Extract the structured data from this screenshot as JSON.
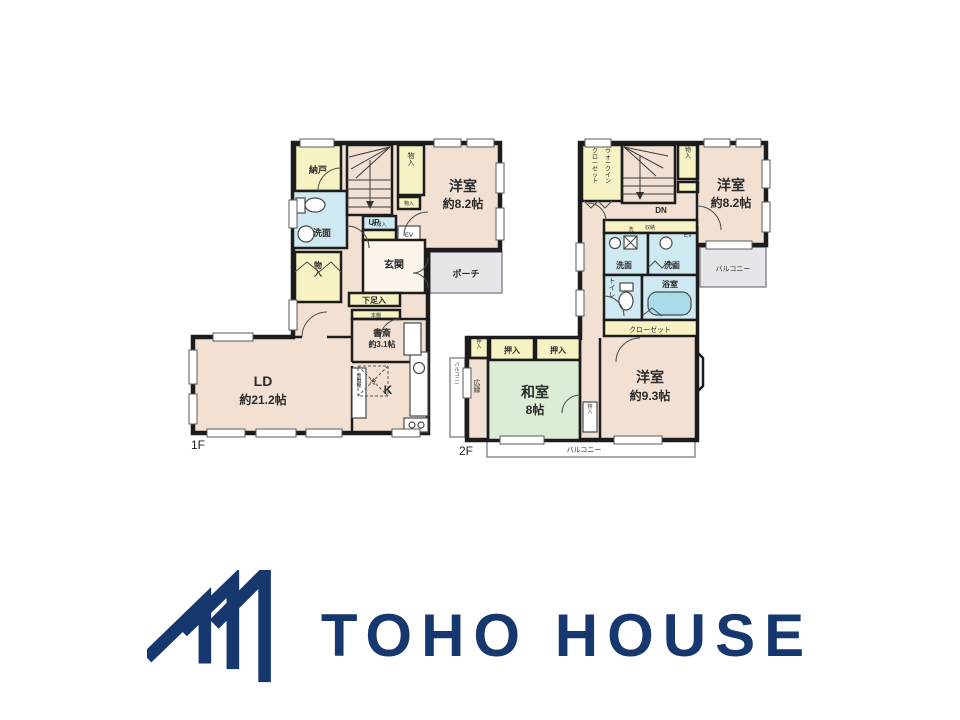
{
  "colors": {
    "brand_navy": "#17386E",
    "wall": "#1C1C1C",
    "room_beige": "#F2E1D2",
    "closet_yellow": "#F6F2C3",
    "wet_blue": "#CFE9F2",
    "tatami_green": "#DCEDD6",
    "exterior_gray": "#E6E5EA",
    "tub_cyan": "#A9DCEA"
  },
  "floor1": {
    "label": "1F",
    "rooms": {
      "nando": "納戸",
      "senmen": "洗面",
      "monoire_left": "物入",
      "stairs": "UP",
      "monoire_top": "物入",
      "coat_closet": "洋服入",
      "shoe_strip": "物入",
      "elevator": "EV",
      "yoshitsu_name": "洋室",
      "yoshitsu_size": "約8.2帖",
      "genkan": "玄関",
      "porch": "ポーチ",
      "getabako": "下足入",
      "bookshelf": "本棚",
      "shosai_name": "書斎",
      "shosai_size": "約3.1帖",
      "fridge": "冷",
      "ld_name": "LD",
      "ld_size": "約21.2帖",
      "kitchen": "K",
      "cupboard": "食器棚"
    }
  },
  "floor2": {
    "label": "2F",
    "rooms": {
      "wic_col_right": "ウォークイン",
      "wic_col_left": "クローゼット",
      "stairs": "DN",
      "monoire_top": "物入",
      "elevator": "EV",
      "yoshitsu1_name": "洋室",
      "yoshitsu1_size": "約8.2帖",
      "balcony_right": "バルコニー",
      "shuno": "収納",
      "washer": "洗",
      "senmen_left": "洗面",
      "senmen_right": "洗面",
      "toilet": "トイレ",
      "bath": "浴室",
      "closet": "クローゼット",
      "oshiire_small": "押入",
      "oshiire_a": "押入",
      "oshiire_b": "押入",
      "balcony_left": "バルコニー",
      "hiroen": "広縁",
      "washitsu_name": "和室",
      "washitsu_size": "8帖",
      "monoire_mid": "物入",
      "yoshitsu2_name": "洋室",
      "yoshitsu2_size": "約9.3帖",
      "balcony_bottom": "バルコニー"
    }
  },
  "logo": {
    "brand": "TOHO HOUSE"
  }
}
